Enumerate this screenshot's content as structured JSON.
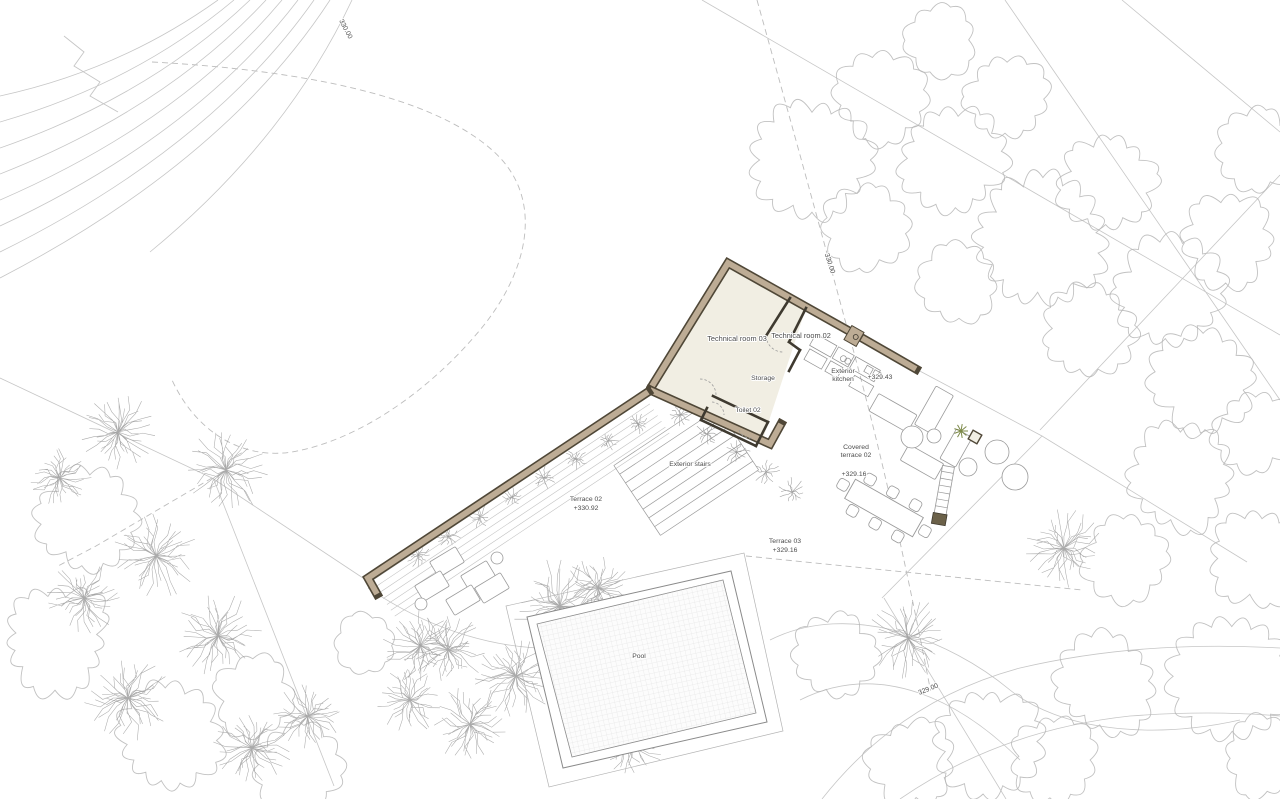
{
  "drawing": {
    "type": "architectural-site-plan",
    "colors": {
      "wall_fill": "#bdac95",
      "wall_outline": "#4f4737",
      "room_fill": "#f1eee3",
      "line_light": "#c6c6c6",
      "line_mid": "#9a9a9a",
      "line_dark": "#3f3a30",
      "text": "#4c4c4c",
      "tree": "#b6b6b6",
      "palm": "#9b9b9b",
      "hedge": "#8d8d8d",
      "plant_green": "#7d8a4a",
      "pool_grid": "#dedede"
    },
    "labels": [
      {
        "id": "technical-room-03",
        "lines": [
          "Technical room 03"
        ],
        "x": 737,
        "y": 341,
        "size": 7,
        "rot": 0
      },
      {
        "id": "technical-room-02",
        "lines": [
          "Technical room 02"
        ],
        "x": 801,
        "y": 338,
        "size": 7,
        "rot": 0
      },
      {
        "id": "storage",
        "lines": [
          "Storage"
        ],
        "x": 763,
        "y": 380,
        "size": 6.5,
        "rot": 0
      },
      {
        "id": "toilet-02",
        "lines": [
          "Toilet 02"
        ],
        "x": 748,
        "y": 412,
        "size": 6.5,
        "rot": 0
      },
      {
        "id": "exterior-kitchen",
        "lines": [
          "Exterior",
          "kitchen"
        ],
        "x": 843,
        "y": 373,
        "size": 6.5,
        "rot": 0,
        "lh": 8
      },
      {
        "id": "kitchen-elevation",
        "lines": [
          "+329.43"
        ],
        "x": 880,
        "y": 379,
        "size": 6.5,
        "rot": 0
      },
      {
        "id": "covered-terrace-02",
        "lines": [
          "Covered",
          "terrace 02"
        ],
        "x": 856,
        "y": 449,
        "size": 6.5,
        "rot": 0,
        "lh": 8
      },
      {
        "id": "covered-terrace-elevation",
        "lines": [
          "+329.16"
        ],
        "x": 854,
        "y": 476,
        "size": 6.5,
        "rot": 0
      },
      {
        "id": "terrace-02",
        "lines": [
          "Terrace 02",
          "+330.92"
        ],
        "x": 586,
        "y": 501,
        "size": 6.5,
        "rot": 0,
        "lh": 9
      },
      {
        "id": "terrace-03",
        "lines": [
          "Terrace 03",
          "+329.16"
        ],
        "x": 785,
        "y": 543,
        "size": 6.5,
        "rot": 0,
        "lh": 9
      },
      {
        "id": "exterior-stairs",
        "lines": [
          "Exterior stairs"
        ],
        "x": 690,
        "y": 466,
        "size": 6.5,
        "rot": 0
      },
      {
        "id": "pool",
        "lines": [
          "Pool"
        ],
        "x": 639,
        "y": 658,
        "size": 6.5,
        "rot": 0
      },
      {
        "id": "contour-330-top",
        "lines": [
          "330.00"
        ],
        "x": 344,
        "y": 30,
        "size": 6.5,
        "rot": 62
      },
      {
        "id": "contour-330-right",
        "lines": [
          "330.00"
        ],
        "x": 828,
        "y": 264,
        "size": 6.5,
        "rot": 72
      },
      {
        "id": "contour-329-bottom",
        "lines": [
          "329.00"
        ],
        "x": 929,
        "y": 691,
        "size": 6.5,
        "rot": -22
      }
    ],
    "house_fill": [
      [
        728,
        263
      ],
      [
        806,
        308
      ],
      [
        762,
        442
      ],
      [
        650,
        390
      ]
    ],
    "wall_chains": [
      [
        [
          849,
          331
        ],
        [
          728,
          263
        ],
        [
          652,
          386
        ]
      ],
      [
        [
          862,
          338
        ],
        [
          916,
          369
        ]
      ],
      [
        [
          650,
          390
        ],
        [
          770,
          444
        ],
        [
          781,
          424
        ]
      ],
      [
        [
          648,
          392
        ],
        [
          368,
          578
        ],
        [
          377,
          594
        ]
      ]
    ],
    "interior_walls": [
      [
        [
          790,
          298
        ],
        [
          766,
          336
        ]
      ],
      [
        [
          806,
          308
        ],
        [
          789,
          342
        ]
      ],
      [
        [
          789,
          342
        ],
        [
          800,
          350
        ]
      ],
      [
        [
          800,
          350
        ],
        [
          789,
          371
        ]
      ],
      [
        [
          713,
          396
        ],
        [
          768,
          422
        ]
      ],
      [
        [
          768,
          422
        ],
        [
          756,
          446
        ]
      ],
      [
        [
          756,
          446
        ],
        [
          701,
          420
        ]
      ],
      [
        [
          701,
          420
        ],
        [
          707,
          408
        ]
      ]
    ],
    "door_arcs": [
      "M766,336 A17 17 0 0 0 783,352",
      "M700,379 A16 16 0 0 1 716,395",
      "M712,402 A13 13 0 0 1 724,415",
      "M739,430 A12 12 0 0 0 752,438"
    ],
    "contours": [
      "M218,0 Q120,70 0,96",
      "M234,0 Q135,83 0,122",
      "M250,0 Q150,96 0,148",
      "M266,0 Q165,109 0,174",
      "M282,0 Q180,122 0,200",
      "M298,0 Q195,135 0,226",
      "M314,0 Q210,148 0,252",
      "M330,0 Q225,161 0,278",
      "M352,0 Q286,140 150,252"
    ],
    "zigzag": "M64,36 L84,52 L74,66 L100,82 L90,96 L118,112",
    "site_solid": [
      "M0,378 L212,478",
      "M212,478 L366,580",
      "M214,480 L334,786",
      "M702,0 L1280,335",
      "M1005,0 L1280,400",
      "M1280,175 L1040,430",
      "M1122,0 L1280,132",
      "M916,369 L1042,436 L882,598",
      "M1042,436 L1247,562",
      "M884,598 L1006,799",
      "M822,799 Q900,700 1020,668 Q1140,640 1280,648",
      "M900,799 Q1000,730 1130,716 Q1210,710 1280,716",
      "M368,588 C430,630 500,652 570,648 C610,646 640,636 660,620",
      "M770,640 C850,600 950,640 1010,690 C1060,730 1150,740 1240,720",
      "M800,700 C880,660 960,700 1020,760"
    ],
    "site_dashed": [
      "M152,62 C300,70 430,95 492,150 C545,196 530,270 480,330 C430,390 360,440 292,452 C240,460 195,430 172,380",
      "M757,0 Q810,190 845,320 Q890,480 930,688",
      "M212,478 L96,546 L58,566",
      "M746,556 L1082,590"
    ],
    "stairs": {
      "start": [
        712,
        400
      ],
      "dirx": -0.832,
      "diry": 0.555,
      "perpx": 0.555,
      "perpy": 0.832,
      "treads": 9,
      "spacing": 10.5,
      "len": 118
    },
    "paving": {
      "startx": 646,
      "starty": 398,
      "count": 7,
      "spacing": 7,
      "dirx": -0.832,
      "diry": 0.555,
      "len": 330
    },
    "pool": {
      "outer": [
        [
          527,
          617
        ],
        [
          731,
          571
        ],
        [
          767,
          722
        ],
        [
          563,
          768
        ]
      ],
      "inner": [
        [
          537,
          624
        ],
        [
          723,
          580
        ],
        [
          756,
          713
        ],
        [
          572,
          757
        ]
      ],
      "deck": [
        [
          506,
          606
        ],
        [
          744,
          553
        ],
        [
          783,
          731
        ],
        [
          549,
          787
        ]
      ],
      "grid_angle": -12.7
    },
    "kitchen": {
      "x": 816,
      "y": 334,
      "rot": 29.5,
      "rects": [
        [
          0,
          0,
          24,
          13
        ],
        [
          26,
          0,
          18,
          13
        ],
        [
          46,
          0,
          28,
          13
        ],
        [
          2,
          16,
          20,
          12
        ],
        [
          26,
          16,
          14,
          12
        ],
        [
          54,
          17,
          22,
          12
        ],
        [
          60,
          2,
          7,
          7
        ],
        [
          69,
          2,
          7,
          7
        ]
      ],
      "circles": [
        [
          36,
          8,
          3
        ],
        [
          41,
          8,
          3
        ]
      ]
    },
    "gate": {
      "x": 854,
      "y": 336,
      "rot": 29.5
    },
    "firepit": {
      "x": 975,
      "y": 437,
      "rot": 29.5
    },
    "plant": {
      "x": 961,
      "y": 431,
      "r": 7
    },
    "ladder": {
      "x": 944,
      "y": 492,
      "rot": 10
    },
    "furniture_rects": [
      {
        "x": 893,
        "y": 413,
        "w": 44,
        "h": 20,
        "rot": 29.5
      },
      {
        "x": 934,
        "y": 410,
        "w": 20,
        "h": 44,
        "rot": 29.5
      },
      {
        "x": 922,
        "y": 462,
        "w": 40,
        "h": 18,
        "rot": 29.5
      },
      {
        "x": 956,
        "y": 448,
        "w": 18,
        "h": 34,
        "rot": 29.5
      }
    ],
    "furniture_circles": [
      [
        912,
        437,
        11
      ],
      [
        934,
        436,
        7
      ],
      [
        968,
        467,
        9
      ],
      [
        997,
        452,
        12
      ],
      [
        1015,
        477,
        13
      ]
    ],
    "table": {
      "x": 884,
      "y": 508,
      "rot": 29.5,
      "w": 78,
      "h": 22,
      "chairs": [
        [
          -26,
          18
        ],
        [
          0,
          18
        ],
        [
          26,
          18
        ],
        [
          -26,
          -18
        ],
        [
          0,
          -18
        ],
        [
          26,
          -18
        ],
        [
          47,
          0
        ],
        [
          -47,
          0
        ]
      ]
    },
    "loungers": {
      "rot": -31,
      "w": 30,
      "h": 18,
      "rects": [
        [
          447,
          562
        ],
        [
          478,
          576
        ],
        [
          432,
          586
        ],
        [
          463,
          600
        ],
        [
          492,
          588
        ]
      ],
      "circles": [
        [
          421,
          604
        ],
        [
          497,
          558
        ]
      ]
    },
    "trees": {
      "fluffy": [
        [
          812,
          160,
          55
        ],
        [
          880,
          98,
          42
        ],
        [
          952,
          160,
          50
        ],
        [
          1006,
          98,
          40
        ],
        [
          1040,
          240,
          60
        ],
        [
          1108,
          182,
          46
        ],
        [
          1168,
          296,
          52
        ],
        [
          1228,
          240,
          44
        ],
        [
          1088,
          332,
          44
        ],
        [
          1204,
          382,
          48
        ],
        [
          958,
          282,
          38
        ],
        [
          868,
          226,
          40
        ],
        [
          1259,
          150,
          40
        ],
        [
          940,
          40,
          35
        ],
        [
          1256,
          430,
          40
        ],
        [
          1180,
          478,
          50
        ],
        [
          1256,
          556,
          46
        ],
        [
          1128,
          556,
          42
        ],
        [
          1232,
          676,
          55
        ],
        [
          1106,
          684,
          46
        ],
        [
          988,
          742,
          50
        ],
        [
          1262,
          758,
          38
        ],
        [
          912,
          764,
          42
        ],
        [
          1052,
          758,
          40
        ],
        [
          836,
          656,
          40
        ],
        [
          86,
          518,
          46
        ],
        [
          56,
          638,
          50
        ],
        [
          168,
          738,
          50
        ],
        [
          298,
          770,
          42
        ],
        [
          366,
          644,
          32
        ],
        [
          254,
          696,
          38
        ]
      ],
      "palm": [
        [
          118,
          432,
          40
        ],
        [
          226,
          470,
          44
        ],
        [
          156,
          556,
          44
        ],
        [
          84,
          598,
          38
        ],
        [
          218,
          636,
          44
        ],
        [
          128,
          698,
          44
        ],
        [
          252,
          748,
          40
        ],
        [
          60,
          478,
          32
        ],
        [
          308,
          716,
          36
        ],
        [
          420,
          646,
          38
        ],
        [
          560,
          606,
          48
        ],
        [
          516,
          676,
          44
        ],
        [
          448,
          650,
          40
        ],
        [
          410,
          700,
          34
        ],
        [
          598,
          588,
          36
        ],
        [
          630,
          742,
          36
        ],
        [
          470,
          724,
          40
        ],
        [
          908,
          638,
          42
        ],
        [
          1064,
          548,
          40
        ]
      ],
      "hedge": [
        [
          418,
          556,
          14
        ],
        [
          448,
          537,
          13
        ],
        [
          480,
          517,
          13
        ],
        [
          512,
          497,
          13
        ],
        [
          544,
          478,
          12
        ],
        [
          576,
          459,
          12
        ],
        [
          608,
          441,
          12
        ],
        [
          638,
          424,
          11
        ],
        [
          680,
          415,
          12
        ],
        [
          707,
          434,
          13
        ],
        [
          737,
          452,
          14
        ],
        [
          766,
          472,
          15
        ],
        [
          792,
          492,
          15
        ]
      ]
    }
  }
}
